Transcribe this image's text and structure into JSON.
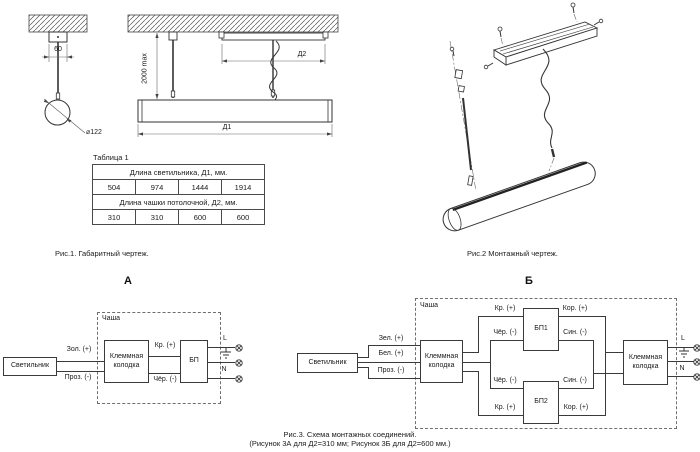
{
  "fig1": {
    "caption": "Рис.1. Габаритный чертеж.",
    "labels": {
      "dim60": "60",
      "diameter": "⌀122",
      "height_max": "2000 max",
      "d1": "Д1",
      "d2": "Д2"
    }
  },
  "table1": {
    "title": "Таблица 1",
    "header_d1": "Длина светильника, Д1, мм.",
    "d1_values": [
      "504",
      "974",
      "1444",
      "1914"
    ],
    "header_d2": "Длина чашки потолочной, Д2, мм.",
    "d2_values": [
      "310",
      "310",
      "600",
      "600"
    ]
  },
  "fig2": {
    "caption": "Рис.2 Монтажный чертеж."
  },
  "fig3": {
    "caption_line1": "Рис.3. Схема монтажных соединений.",
    "caption_line2": "(Рисунок 3А для Д2=310 мм; Рисунок 3Б для Д2=600 мм.)",
    "diagram_a": {
      "title": "А",
      "cup_label": "Чаша",
      "luminaire": "Светильник",
      "terminal_block": "Клеммная колодка",
      "psu": "БП",
      "wire_gold": "Зол. (+)",
      "wire_transparent": "Проз. (-)",
      "wire_red": "Кр. (+)",
      "wire_black": "Чёр. (-)",
      "line_l": "L",
      "line_n": "N"
    },
    "diagram_b": {
      "title": "Б",
      "cup_label": "Чаша",
      "luminaire": "Светильник",
      "terminal_block": "Клеммная колодка",
      "psu1": "БП1",
      "psu2": "БП2",
      "wire_green": "Зел. (+)",
      "wire_white": "Бел. (+)",
      "wire_transparent": "Проз. (-)",
      "wire_red": "Кр. (+)",
      "wire_black": "Чёр. (-)",
      "wire_brown": "Кор. (+)",
      "wire_blue": "Син. (-)",
      "line_l": "L",
      "line_n": "N"
    }
  }
}
